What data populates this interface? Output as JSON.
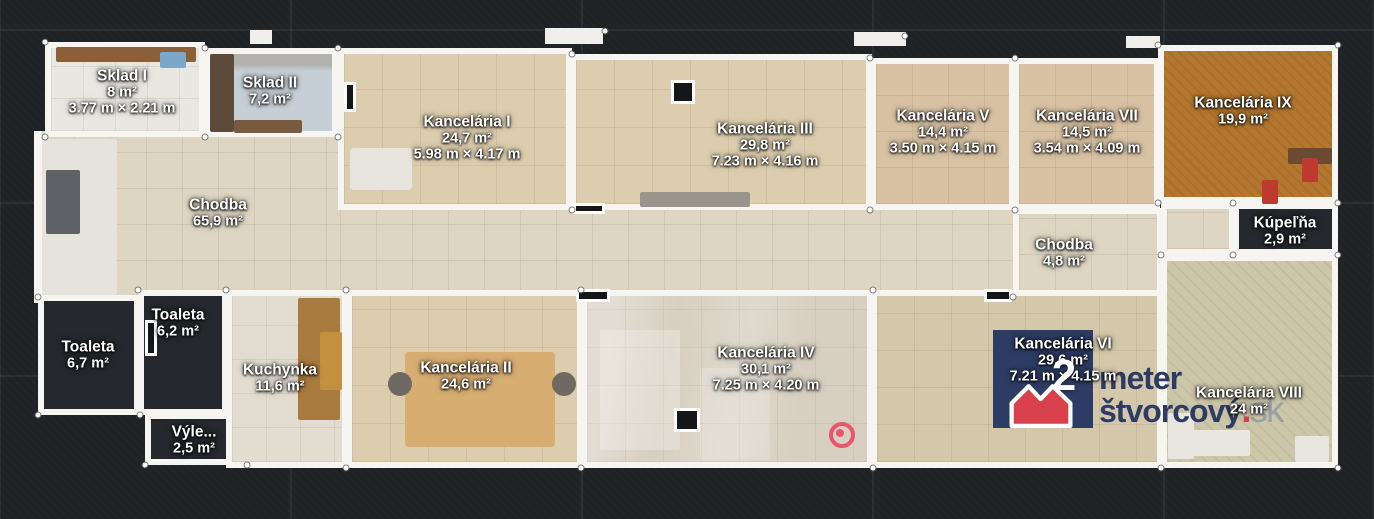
{
  "view": {
    "type": "floor-plan-top-view"
  },
  "colors": {
    "background": "#202326",
    "wall": "#f6f5f2",
    "label_text": "#ffffff",
    "scan_marker": "#ee4d68",
    "watermark_navy": "#2d3c64",
    "watermark_red": "#d8414b",
    "watermark_gray": "#99a1a8"
  },
  "rooms": [
    {
      "id": "chodba-main-a",
      "name": "Chodba",
      "area": "65,9 m²",
      "dims": null,
      "rect": [
        38,
        131,
        302,
        166
      ],
      "floor": "corridor",
      "walls": false,
      "label": [
        218,
        213
      ]
    },
    {
      "id": "chodba-main-b",
      "name": null,
      "area": null,
      "dims": null,
      "rect": [
        340,
        204,
        673,
        93
      ],
      "floor": "corridor",
      "walls": false,
      "label": null
    },
    {
      "id": "sklad-1",
      "name": "Sklad I",
      "area": "8 m²",
      "dims": "3.77 m × 2.21 m",
      "rect": [
        45,
        42,
        160,
        95
      ],
      "floor": "light",
      "walls": true,
      "label": [
        122,
        92
      ]
    },
    {
      "id": "sklad-2",
      "name": "Sklad II",
      "area": "7,2 m²",
      "dims": null,
      "rect": [
        205,
        48,
        133,
        89
      ],
      "floor": "bluegray",
      "walls": true,
      "label": [
        270,
        91
      ]
    },
    {
      "id": "kancelaria-1",
      "name": "Kancelária I",
      "area": "24,7 m²",
      "dims": "5.98 m × 4.17 m",
      "rect": [
        338,
        48,
        234,
        162
      ],
      "floor": "beige",
      "walls": true,
      "label": [
        467,
        138
      ]
    },
    {
      "id": "kancelaria-3",
      "name": "Kancelária III",
      "area": "29,8 m²",
      "dims": "7.23 m × 4.16 m",
      "rect": [
        570,
        54,
        302,
        156
      ],
      "floor": "beige",
      "walls": true,
      "label": [
        765,
        145
      ]
    },
    {
      "id": "kancelaria-5",
      "name": "Kancelária V",
      "area": "14,4 m²",
      "dims": "3.50 m × 4.15 m",
      "rect": [
        870,
        58,
        145,
        152
      ],
      "floor": "tan",
      "walls": true,
      "label": [
        943,
        132
      ]
    },
    {
      "id": "kancelaria-7",
      "name": "Kancelária VII",
      "area": "14,5 m²",
      "dims": "3.54 m × 4.09 m",
      "rect": [
        1013,
        58,
        147,
        152
      ],
      "floor": "tan",
      "walls": true,
      "label": [
        1087,
        132
      ]
    },
    {
      "id": "kancelaria-9",
      "name": "Kancelária IX",
      "area": "19,9 m²",
      "dims": null,
      "rect": [
        1158,
        45,
        180,
        158
      ],
      "floor": "orange",
      "walls": true,
      "label": [
        1243,
        111
      ]
    },
    {
      "id": "chodba-small",
      "name": "Chodba",
      "area": "4,8 m²",
      "dims": null,
      "rect": [
        1013,
        208,
        150,
        89
      ],
      "floor": "corridor",
      "walls": true,
      "label": [
        1064,
        253
      ]
    },
    {
      "id": "passage",
      "name": null,
      "area": null,
      "dims": null,
      "rect": [
        1161,
        203,
        74,
        52
      ],
      "floor": "corridor",
      "walls": true,
      "label": null
    },
    {
      "id": "kupelna",
      "name": "Kúpeľňa",
      "area": "2,9 m²",
      "dims": null,
      "rect": [
        1233,
        203,
        105,
        52
      ],
      "floor": "dark",
      "walls": true,
      "label": [
        1285,
        231
      ]
    },
    {
      "id": "toaleta-1",
      "name": "Toaleta",
      "area": "6,7 m²",
      "dims": null,
      "rect": [
        38,
        295,
        102,
        120
      ],
      "floor": "dark",
      "walls": true,
      "label": [
        88,
        355
      ]
    },
    {
      "id": "toaleta-2",
      "name": "Toaleta",
      "area": "6,2 m²",
      "dims": null,
      "rect": [
        138,
        290,
        90,
        125
      ],
      "floor": "dark",
      "walls": true,
      "label": [
        178,
        323
      ]
    },
    {
      "id": "vylevka",
      "name": "Výle...",
      "area": "2,5 m²",
      "dims": null,
      "rect": [
        145,
        413,
        102,
        52
      ],
      "floor": "dark",
      "walls": true,
      "label": [
        194,
        440
      ]
    },
    {
      "id": "kuchynka",
      "name": "Kuchynka",
      "area": "11,6 m²",
      "dims": null,
      "rect": [
        226,
        290,
        122,
        178
      ],
      "floor": "kitchen",
      "walls": true,
      "label": [
        280,
        378
      ]
    },
    {
      "id": "kancelaria-2",
      "name": "Kancelária II",
      "area": "24,6 m²",
      "dims": null,
      "rect": [
        346,
        290,
        237,
        178
      ],
      "floor": "beige",
      "walls": true,
      "label": [
        466,
        376
      ]
    },
    {
      "id": "kancelaria-4",
      "name": "Kancelária IV",
      "area": "30,1 m²",
      "dims": "7.25 m × 4.20 m",
      "rect": [
        581,
        290,
        292,
        178
      ],
      "floor": "pale",
      "walls": true,
      "label": [
        766,
        369
      ]
    },
    {
      "id": "kancelaria-6",
      "name": "Kancelária VI",
      "area": "29,6 m²",
      "dims": "7.21 m × 4.15 m",
      "rect": [
        871,
        290,
        292,
        178
      ],
      "floor": "beige2",
      "walls": true,
      "label": [
        1063,
        360
      ]
    },
    {
      "id": "kancelaria-8",
      "name": "Kancelária VIII",
      "area": "24 m²",
      "dims": null,
      "rect": [
        1161,
        255,
        177,
        213
      ],
      "floor": "sage",
      "walls": true,
      "label": [
        1249,
        401
      ]
    }
  ],
  "wall_segments": [
    [
      34,
      131,
      8,
      172
    ]
  ],
  "wall_stubs": [
    [
      545,
      28,
      58,
      16
    ],
    [
      854,
      32,
      52,
      14
    ],
    [
      1126,
      36,
      34,
      12
    ],
    [
      250,
      30,
      22,
      14
    ]
  ],
  "door_markers": [
    [
      576,
      289,
      34,
      13
    ],
    [
      984,
      289,
      28,
      13
    ],
    [
      573,
      203,
      32,
      11
    ],
    [
      344,
      82,
      12,
      30
    ],
    [
      671,
      80,
      24,
      24
    ],
    [
      674,
      408,
      26,
      24
    ],
    [
      145,
      320,
      12,
      36
    ]
  ],
  "furniture": [
    {
      "rect": [
        42,
        139,
        75,
        156
      ],
      "color": "#e6e3dc"
    },
    {
      "rect": [
        46,
        170,
        34,
        64
      ],
      "color": "#5e6165"
    },
    {
      "rect": [
        56,
        47,
        140,
        15
      ],
      "color": "#8a5f3a"
    },
    {
      "rect": [
        160,
        52,
        26,
        16
      ],
      "color": "#7ba7c9"
    },
    {
      "rect": [
        210,
        54,
        24,
        78
      ],
      "color": "#5d4a3a"
    },
    {
      "rect": [
        234,
        120,
        68,
        13
      ],
      "color": "#7a5a3f"
    },
    {
      "rect": [
        350,
        148,
        62,
        42,
        "r"
      ],
      "color": "#e8e5de"
    },
    {
      "rect": [
        640,
        192,
        110,
        15
      ],
      "color": "#9a958c"
    },
    {
      "rect": [
        298,
        298,
        42,
        122
      ],
      "color": "#a97a3d"
    },
    {
      "rect": [
        320,
        332,
        22,
        58
      ],
      "color": "#c1913f"
    },
    {
      "rect": [
        405,
        352,
        150,
        95,
        "r"
      ],
      "color": "#d8ad72"
    },
    {
      "rect": [
        388,
        372,
        24,
        24,
        "o"
      ],
      "color": "#6e6a63"
    },
    {
      "rect": [
        552,
        372,
        24,
        24,
        "o"
      ],
      "color": "#6e6a63"
    },
    {
      "rect": [
        600,
        330,
        80,
        120
      ],
      "color": "rgba(255,255,255,0.25)"
    },
    {
      "rect": [
        700,
        368,
        70,
        92
      ],
      "color": "rgba(255,255,255,0.18)"
    },
    {
      "rect": [
        1288,
        148,
        44,
        16
      ],
      "color": "#6b4a33"
    },
    {
      "rect": [
        1302,
        158,
        16,
        24
      ],
      "color": "#c0392f"
    },
    {
      "rect": [
        1262,
        180,
        16,
        24
      ],
      "color": "#c0392f"
    },
    {
      "rect": [
        1190,
        430,
        60,
        26
      ],
      "color": "#e9e6df"
    },
    {
      "rect": [
        1168,
        413,
        26,
        46
      ],
      "color": "#e9e6df"
    },
    {
      "rect": [
        1295,
        436,
        34,
        26
      ],
      "color": "#e9e6df"
    }
  ],
  "corner_dots": [
    [
      45,
      42
    ],
    [
      205,
      48
    ],
    [
      205,
      137
    ],
    [
      338,
      48
    ],
    [
      338,
      137
    ],
    [
      45,
      137
    ],
    [
      572,
      54
    ],
    [
      572,
      210
    ],
    [
      870,
      58
    ],
    [
      870,
      210
    ],
    [
      1015,
      58
    ],
    [
      1015,
      210
    ],
    [
      1158,
      45
    ],
    [
      1338,
      45
    ],
    [
      1158,
      203
    ],
    [
      1233,
      203
    ],
    [
      1338,
      203
    ],
    [
      1233,
      255
    ],
    [
      1338,
      255
    ],
    [
      38,
      297
    ],
    [
      38,
      415
    ],
    [
      140,
      415
    ],
    [
      145,
      465
    ],
    [
      247,
      465
    ],
    [
      226,
      290
    ],
    [
      346,
      290
    ],
    [
      346,
      468
    ],
    [
      581,
      290
    ],
    [
      581,
      468
    ],
    [
      873,
      290
    ],
    [
      873,
      468
    ],
    [
      1161,
      255
    ],
    [
      1161,
      468
    ],
    [
      1338,
      468
    ],
    [
      1013,
      297
    ],
    [
      138,
      290
    ],
    [
      605,
      31
    ],
    [
      905,
      36
    ]
  ],
  "scan_marker": {
    "x": 842,
    "y": 435
  },
  "watermark": {
    "digit": "2",
    "line1": "meter",
    "line2": "štvorcový",
    "dot": ".",
    "suffix": "sk"
  }
}
